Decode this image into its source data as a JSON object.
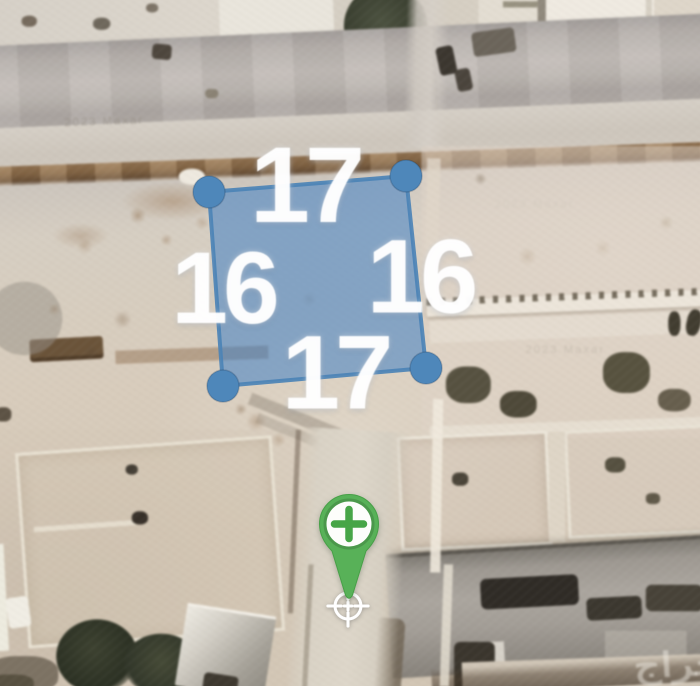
{
  "map": {
    "view": "satellite",
    "imagery_watermark": "2023 Maxar",
    "site_watermark": "حراج"
  },
  "plot": {
    "side_lengths": {
      "top": "17",
      "right": "16",
      "bottom": "17",
      "left": "16"
    },
    "colors": {
      "fill": "#3f7fc4",
      "outline": "#4c83b6",
      "handles": "#4e87ba"
    }
  },
  "marker": {
    "kind": "add-location",
    "color": "#58b158",
    "plus_color": "#47a547"
  }
}
